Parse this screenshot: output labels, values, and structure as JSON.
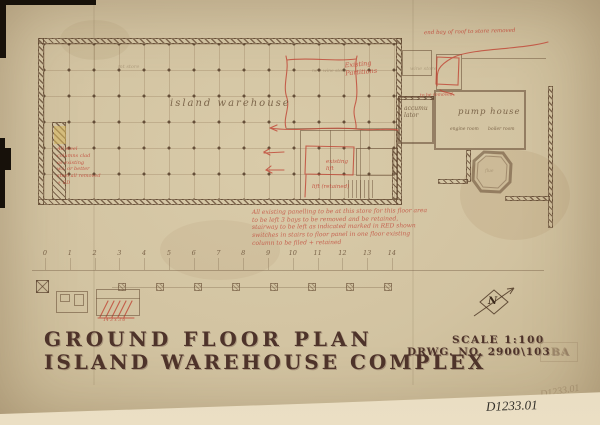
{
  "titleblock": {
    "line1": "GROUND FLOOR PLAN",
    "line2": "ISLAND WAREHOUSE COMPLEX",
    "scale": "SCALE 1:100",
    "drwg": "DRWG. NO. 2900\\103",
    "drwg_ghost": "BA"
  },
  "stamps": {
    "catalog": "D1233.01",
    "catalog_ghost": "D1233.01"
  },
  "plan": {
    "labels": {
      "island_warehouse": "island warehouse",
      "accumulator_l1": "accumu",
      "accumulator_l2": "lator",
      "pump_house": "pump house",
      "engine_room": "engine room",
      "boiler_room": "boiler room",
      "faint_left": "mt store",
      "faint_right": "wine store",
      "pencil_mid": "new wine store",
      "octagon": "flue"
    },
    "red_notes": {
      "top_right": "end bay of roof to store removed",
      "to_be_removed": "to be removed",
      "partitions_l1": "Existing",
      "partitions_l2": "Partitions",
      "lift_a_l1": "existing",
      "lift_a_l2": "lift",
      "lift_b": "lift (retained)",
      "left_block": [
        "All steel",
        "columns clad",
        "as existing",
        "w.i. or better",
        "steel all removed",
        "+ SD"
      ],
      "center_block": [
        "All existing panelling to be at this store for this floor area",
        "to be left 3 bays to be removed and be retained,",
        "stairway to be left as indicated marked in RED shown",
        "switches in stairs to floor panel in one floor existing",
        "column to be filed + retained"
      ],
      "dim": "14'3 x 3'6"
    }
  },
  "scalebar": {
    "numbers": [
      "0",
      "1",
      "2",
      "3",
      "4",
      "5",
      "6",
      "7",
      "8",
      "9",
      "10",
      "11",
      "12",
      "13",
      "14"
    ]
  },
  "compass": {
    "label": "N"
  }
}
